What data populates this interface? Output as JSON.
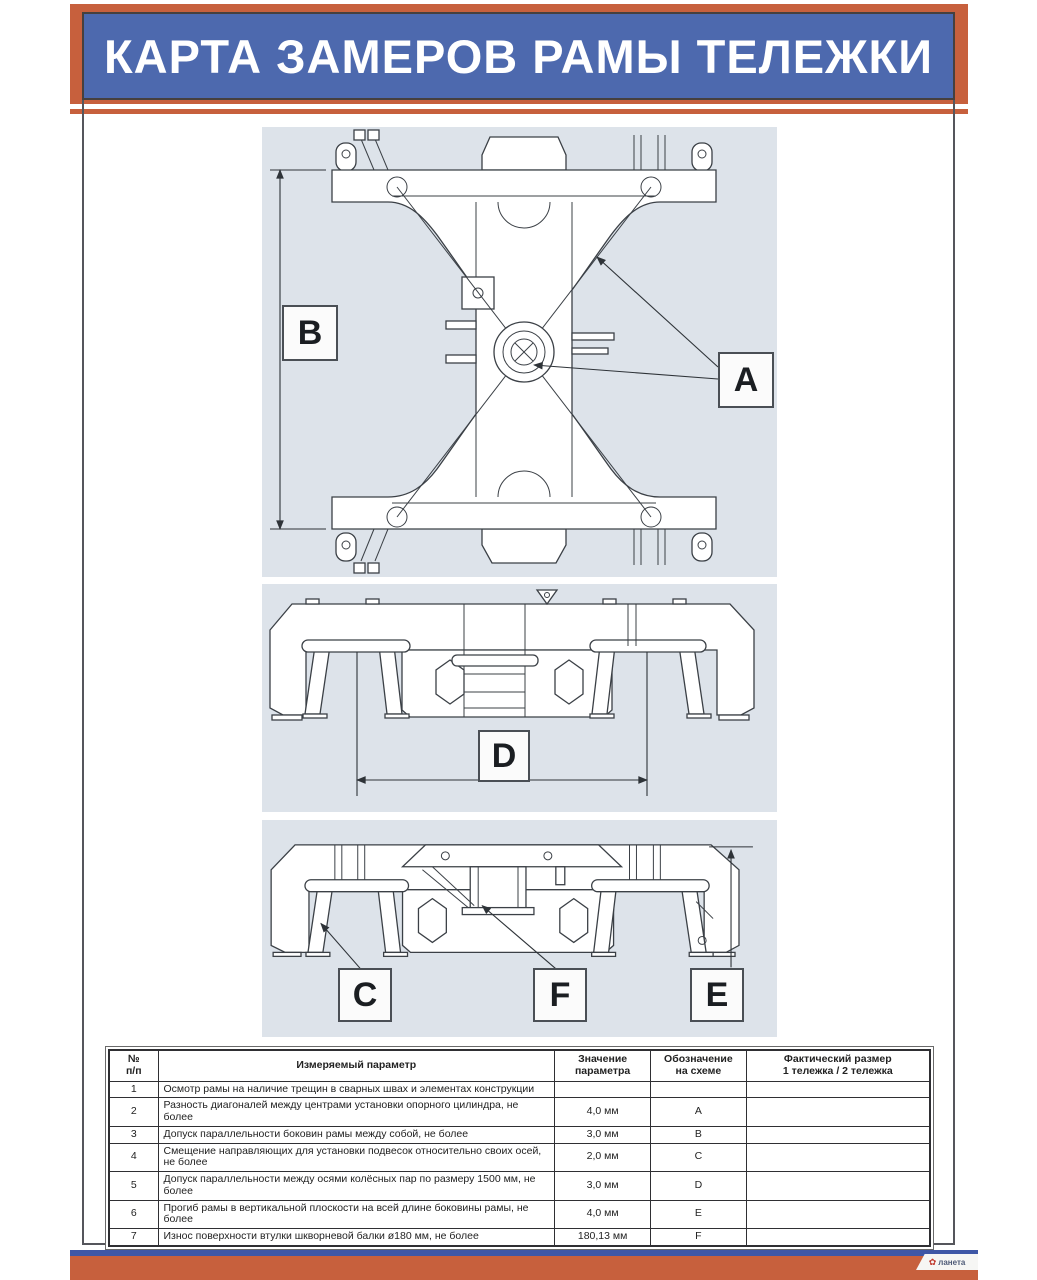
{
  "header": {
    "title": "КАРТА ЗАМЕРОВ РАМЫ ТЕЛЕЖКИ"
  },
  "colors": {
    "accent_orange": "#c7603d",
    "title_blue": "#4d69ae",
    "footer_stripe_blue": "#3e57a6",
    "panel_background": "#dde3ea",
    "drawing_line": "#3b4046"
  },
  "diagram_labels": {
    "a": "A",
    "b": "B",
    "c": "C",
    "d": "D",
    "e": "E",
    "f": "F"
  },
  "table": {
    "headers": {
      "num": "№\nп/п",
      "param": "Измеряемый параметр",
      "value": "Значение\nпараметра",
      "designation": "Обозначение\nна схеме",
      "actual": "Фактический размер\n1 тележка / 2 тележка"
    },
    "rows": [
      {
        "num": "1",
        "param": "Осмотр рамы на наличие трещин в сварных швах и элементах конструкции",
        "value": "",
        "designation": "",
        "actual": ""
      },
      {
        "num": "2",
        "param": "Разность диагоналей между центрами установки опорного цилиндра, не более",
        "value": "4,0 мм",
        "designation": "A",
        "actual": ""
      },
      {
        "num": "3",
        "param": "Допуск параллельности боковин рамы между собой, не более",
        "value": "3,0 мм",
        "designation": "B",
        "actual": ""
      },
      {
        "num": "4",
        "param": "Смещение направляющих для установки подвесок относительно своих осей, не более",
        "value": "2,0 мм",
        "designation": "C",
        "actual": ""
      },
      {
        "num": "5",
        "param": "Допуск параллельности между осями колёсных пар по размеру 1500 мм, не более",
        "value": "3,0 мм",
        "designation": "D",
        "actual": ""
      },
      {
        "num": "6",
        "param": "Прогиб рамы в вертикальной плоскости на всей длине боковины рамы, не более",
        "value": "4,0 мм",
        "designation": "E",
        "actual": ""
      },
      {
        "num": "7",
        "param": "Износ поверхности втулки шкворневой балки ø180 мм, не более",
        "value": "180,13 мм",
        "designation": "F",
        "actual": ""
      }
    ]
  },
  "footer": {
    "logo_text": "ланета"
  }
}
